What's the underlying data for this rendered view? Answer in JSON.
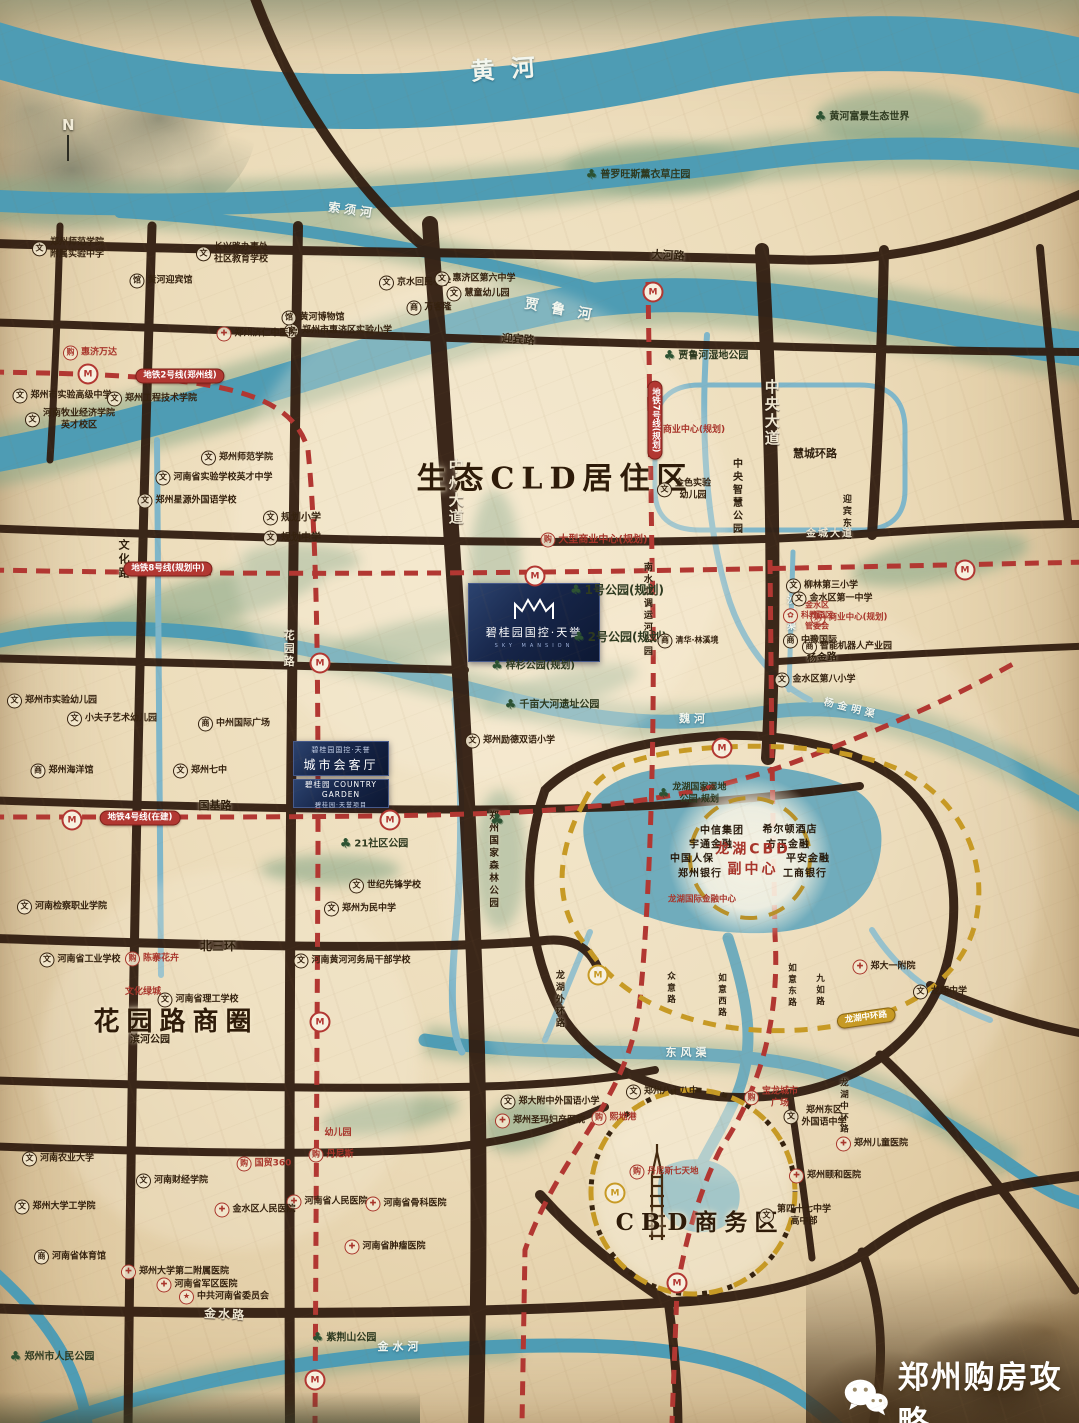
{
  "watermark": {
    "text": "郑州购房攻略"
  },
  "compass": {
    "label": "N"
  },
  "project": {
    "main_card": {
      "name": "碧桂园国控·天誉",
      "subtitle": "SKY MANSION"
    },
    "card2": {
      "line1": "碧桂园国控·天誉",
      "line2": "城市会客厅"
    },
    "card3": {
      "brand": "碧桂园 COUNTRY GARDEN",
      "line2": "碧桂园·天誉项目"
    }
  },
  "colors": {
    "parchment": "#ecdcba",
    "river": "#4e9cb4",
    "road": "#311d10",
    "metro_red": "#b23732",
    "ring_yellow": "#c79a25",
    "label_dark": "#35220f",
    "red_text": "#a8352b",
    "project_navy": "#17264a",
    "green": "#7fa383"
  },
  "map": {
    "labels": [
      {
        "x": 505,
        "y": 70,
        "t": "黄  河",
        "k": "river",
        "fs": 24,
        "r": -4
      },
      {
        "x": 352,
        "y": 211,
        "t": "索须河",
        "k": "river",
        "fs": 12,
        "r": 8
      },
      {
        "x": 560,
        "y": 310,
        "t": "贾 鲁 河",
        "k": "river",
        "fs": 14,
        "r": 10
      },
      {
        "x": 688,
        "y": 1053,
        "t": "东风渠",
        "k": "river",
        "fs": 11
      },
      {
        "x": 400,
        "y": 1347,
        "t": "金水河",
        "k": "river",
        "fs": 11
      },
      {
        "x": 851,
        "y": 709,
        "t": "杨金明渠",
        "k": "river",
        "fs": 10,
        "r": 14
      },
      {
        "x": 694,
        "y": 719,
        "t": "魏河",
        "k": "river",
        "fs": 11
      },
      {
        "x": 789,
        "y": 608,
        "t": "白沙明渠",
        "k": "river",
        "fs": 9,
        "v": 1
      },
      {
        "x": 668,
        "y": 256,
        "t": "大河路",
        "k": "rd",
        "fs": 11,
        "r": 3
      },
      {
        "x": 518,
        "y": 340,
        "t": "迎宾路",
        "k": "rd",
        "fs": 11,
        "r": 4
      },
      {
        "x": 215,
        "y": 806,
        "t": "国基路",
        "k": "rd",
        "fs": 11
      },
      {
        "x": 218,
        "y": 947,
        "t": "北三环",
        "k": "rd",
        "fs": 12
      },
      {
        "x": 822,
        "y": 658,
        "t": "杨金路",
        "k": "rd",
        "fs": 10,
        "r": -4
      },
      {
        "x": 815,
        "y": 454,
        "t": "慧城环路",
        "k": "rd",
        "fs": 11
      },
      {
        "x": 845,
        "y": 518,
        "t": "迎宾东路",
        "k": "rd",
        "fs": 9,
        "v": 1
      },
      {
        "x": 123,
        "y": 560,
        "t": "文化路",
        "k": "rd",
        "fs": 11,
        "v": 1
      },
      {
        "x": 558,
        "y": 1000,
        "t": "龙湖外环路",
        "k": "rd",
        "fs": 9,
        "v": 1
      },
      {
        "x": 670,
        "y": 989,
        "t": "众意路",
        "k": "rd",
        "fs": 8.5,
        "v": 1
      },
      {
        "x": 721,
        "y": 996,
        "t": "如意西路",
        "k": "rd",
        "fs": 8.5,
        "v": 1
      },
      {
        "x": 791,
        "y": 986,
        "t": "如意东路",
        "k": "rd",
        "fs": 8.5,
        "v": 1
      },
      {
        "x": 819,
        "y": 991,
        "t": "九如路",
        "k": "rd",
        "fs": 8.5,
        "v": 1
      },
      {
        "x": 843,
        "y": 1107,
        "t": "龙湖中环路",
        "k": "rd",
        "fs": 8.5,
        "v": 1
      },
      {
        "x": 455,
        "y": 492,
        "t": "中州大道",
        "k": "rw",
        "fs": 15,
        "v": 1
      },
      {
        "x": 771,
        "y": 413,
        "t": "中央大道",
        "k": "rw",
        "fs": 15,
        "v": 1
      },
      {
        "x": 288,
        "y": 649,
        "t": "花园路",
        "k": "rw",
        "fs": 11,
        "v": 1
      },
      {
        "x": 225,
        "y": 1315,
        "t": "金水路",
        "k": "rw",
        "fs": 12,
        "r": 3
      },
      {
        "x": 830,
        "y": 534,
        "t": "金城大道",
        "k": "rw",
        "fs": 10
      },
      {
        "x": 736,
        "y": 497,
        "t": "中央智慧公园",
        "k": "rd",
        "fs": 10,
        "v": 1
      },
      {
        "x": 646,
        "y": 610,
        "t": "南水北调运河公园",
        "k": "rd",
        "fs": 9,
        "v": 1
      },
      {
        "x": 492,
        "y": 860,
        "t": "郑州国家森林公园",
        "k": "rd",
        "fs": 9.5,
        "v": 1
      },
      {
        "x": 555,
        "y": 479,
        "t": "生态CLD居住区",
        "k": "zone",
        "fs": 30
      },
      {
        "x": 176,
        "y": 1023,
        "t": "花园路商圈",
        "k": "zone",
        "fs": 26
      },
      {
        "x": 700,
        "y": 1223,
        "t": "CBD商务区",
        "k": "zone",
        "fs": 23
      },
      {
        "x": 862,
        "y": 117,
        "t": "黄河富景生态世界",
        "k": "park",
        "fs": 10
      },
      {
        "x": 638,
        "y": 175,
        "t": "普罗旺斯薰衣草庄园",
        "k": "park",
        "fs": 10
      },
      {
        "x": 706,
        "y": 356,
        "t": "贾鲁河湿地公园",
        "k": "park",
        "fs": 10
      },
      {
        "x": 617,
        "y": 591,
        "t": "1号公园(规划)",
        "k": "park",
        "fs": 12
      },
      {
        "x": 620,
        "y": 638,
        "t": "2号公园(规划)",
        "k": "park",
        "fs": 12
      },
      {
        "x": 533,
        "y": 666,
        "t": "梓杉公园(规划)",
        "k": "park",
        "fs": 10
      },
      {
        "x": 552,
        "y": 705,
        "t": "千亩大河遗址公园",
        "k": "park",
        "fs": 10
      },
      {
        "x": 374,
        "y": 844,
        "t": "21社区公园",
        "k": "park",
        "fs": 10
      },
      {
        "x": 150,
        "y": 1040,
        "t": "滨河公园",
        "k": "rd",
        "fs": 10
      },
      {
        "x": 692,
        "y": 794,
        "t": "龙湖国家湿地\n公园·规划",
        "k": "park",
        "fs": 9
      },
      {
        "x": 344,
        "y": 1338,
        "t": "紫荆山公园",
        "k": "park",
        "fs": 10
      },
      {
        "x": 52,
        "y": 1357,
        "t": "郑州市人民公园",
        "k": "park",
        "fs": 10
      },
      {
        "x": 497,
        "y": 820,
        "t": "",
        "k": "tree"
      },
      {
        "x": 68,
        "y": 249,
        "t": "郑州师范学院\n附属实验中学",
        "k": "school",
        "fs": 9
      },
      {
        "x": 232,
        "y": 254,
        "t": "长兴路办事处\n社区教育学校",
        "k": "school",
        "fs": 9
      },
      {
        "x": 415,
        "y": 283,
        "t": "京水回民小学",
        "k": "school",
        "fs": 9
      },
      {
        "x": 475,
        "y": 279,
        "t": "惠济区第六中学",
        "k": "school",
        "fs": 9
      },
      {
        "x": 478,
        "y": 294,
        "t": "慧童幼儿园",
        "k": "school",
        "fs": 9
      },
      {
        "x": 338,
        "y": 331,
        "t": "郑州市惠济区实验小学",
        "k": "school",
        "fs": 9
      },
      {
        "x": 62,
        "y": 396,
        "t": "郑州市实验高级中学",
        "k": "school",
        "fs": 9
      },
      {
        "x": 152,
        "y": 399,
        "t": "郑州工程技术学院",
        "k": "school",
        "fs": 9
      },
      {
        "x": 70,
        "y": 420,
        "t": "河南牧业经济学院\n英才校区",
        "k": "school",
        "fs": 9
      },
      {
        "x": 237,
        "y": 458,
        "t": "郑州师范学院",
        "k": "school",
        "fs": 9
      },
      {
        "x": 214,
        "y": 478,
        "t": "河南省实验学校英才中学",
        "k": "school",
        "fs": 9
      },
      {
        "x": 187,
        "y": 501,
        "t": "郑州星源外国语学校",
        "k": "school",
        "fs": 9
      },
      {
        "x": 292,
        "y": 518,
        "t": "规划小学",
        "k": "school",
        "fs": 10
      },
      {
        "x": 292,
        "y": 538,
        "t": "规划中学",
        "k": "school",
        "fs": 10
      },
      {
        "x": 684,
        "y": 490,
        "t": "金色实验\n幼儿园",
        "k": "school",
        "fs": 9
      },
      {
        "x": 510,
        "y": 741,
        "t": "郑州励德双语小学",
        "k": "school",
        "fs": 9
      },
      {
        "x": 200,
        "y": 771,
        "t": "郑州七中",
        "k": "school",
        "fs": 9
      },
      {
        "x": 52,
        "y": 701,
        "t": "郑州市实验幼儿园",
        "k": "school",
        "fs": 9
      },
      {
        "x": 112,
        "y": 719,
        "t": "小夫子艺术幼儿园",
        "k": "school",
        "fs": 9
      },
      {
        "x": 385,
        "y": 886,
        "t": "世纪先锋学校",
        "k": "school",
        "fs": 9
      },
      {
        "x": 360,
        "y": 909,
        "t": "郑州为民中学",
        "k": "school",
        "fs": 9
      },
      {
        "x": 80,
        "y": 960,
        "t": "河南省工业学校",
        "k": "school",
        "fs": 9
      },
      {
        "x": 352,
        "y": 961,
        "t": "河南黄河河务局干部学校",
        "k": "school",
        "fs": 9
      },
      {
        "x": 62,
        "y": 907,
        "t": "河南检察职业学院",
        "k": "school",
        "fs": 9
      },
      {
        "x": 198,
        "y": 1000,
        "t": "河南省理工学校",
        "k": "school",
        "fs": 9
      },
      {
        "x": 58,
        "y": 1159,
        "t": "河南农业大学",
        "k": "school",
        "fs": 9
      },
      {
        "x": 172,
        "y": 1181,
        "t": "河南财经学院",
        "k": "school",
        "fs": 9
      },
      {
        "x": 55,
        "y": 1207,
        "t": "郑州大学工学院",
        "k": "school",
        "fs": 9
      },
      {
        "x": 550,
        "y": 1102,
        "t": "郑大附中外国语小学",
        "k": "school",
        "fs": 9
      },
      {
        "x": 662,
        "y": 1092,
        "t": "郑州八十八中",
        "k": "school",
        "fs": 9
      },
      {
        "x": 815,
        "y": 1117,
        "t": "郑州东区\n外国语中学",
        "k": "school",
        "fs": 9
      },
      {
        "x": 940,
        "y": 992,
        "t": "龙翔中学",
        "k": "school",
        "fs": 9
      },
      {
        "x": 795,
        "y": 1216,
        "t": "第四十七中学\n高中部",
        "k": "school",
        "fs": 9
      },
      {
        "x": 822,
        "y": 586,
        "t": "柳林第三小学",
        "k": "school",
        "fs": 9
      },
      {
        "x": 832,
        "y": 599,
        "t": "金水区第一中学",
        "k": "school",
        "fs": 9
      },
      {
        "x": 815,
        "y": 680,
        "t": "金水区第八小学",
        "k": "school",
        "fs": 9
      },
      {
        "x": 234,
        "y": 724,
        "t": "中州国际广场",
        "k": "biz",
        "fs": 9
      },
      {
        "x": 429,
        "y": 308,
        "t": "万客隆",
        "k": "biz",
        "fs": 9
      },
      {
        "x": 847,
        "y": 647,
        "t": "智能机器人产业园",
        "k": "biz",
        "fs": 9
      },
      {
        "x": 810,
        "y": 641,
        "t": "中豫国际",
        "k": "biz",
        "fs": 9
      },
      {
        "x": 70,
        "y": 1257,
        "t": "河南省体育馆",
        "k": "biz",
        "fs": 9
      },
      {
        "x": 62,
        "y": 771,
        "t": "郑州海洋馆",
        "k": "biz",
        "fs": 9
      },
      {
        "x": 688,
        "y": 641,
        "t": "清华·林溪境",
        "k": "biz",
        "fs": 8
      },
      {
        "x": 313,
        "y": 318,
        "t": "黄河博物馆",
        "k": "mus",
        "fs": 9
      },
      {
        "x": 161,
        "y": 281,
        "t": "黄河迎宾馆",
        "k": "mus",
        "fs": 9
      },
      {
        "x": 257,
        "y": 334,
        "t": "郑州济仁中医院",
        "k": "hosp",
        "fs": 9
      },
      {
        "x": 884,
        "y": 967,
        "t": "郑大一附院",
        "k": "hosp",
        "fs": 9
      },
      {
        "x": 872,
        "y": 1144,
        "t": "郑州儿童医院",
        "k": "hosp",
        "fs": 9
      },
      {
        "x": 825,
        "y": 1176,
        "t": "郑州颐和医院",
        "k": "hosp",
        "fs": 9
      },
      {
        "x": 540,
        "y": 1121,
        "t": "郑州圣玛妇产医院",
        "k": "hosp",
        "fs": 9
      },
      {
        "x": 327,
        "y": 1202,
        "t": "河南省人民医院",
        "k": "hosp",
        "fs": 9
      },
      {
        "x": 406,
        "y": 1204,
        "t": "河南省骨科医院",
        "k": "hosp",
        "fs": 9
      },
      {
        "x": 385,
        "y": 1247,
        "t": "河南省肿瘤医院",
        "k": "hosp",
        "fs": 9
      },
      {
        "x": 255,
        "y": 1210,
        "t": "金水区人民医院",
        "k": "hosp",
        "fs": 9
      },
      {
        "x": 175,
        "y": 1272,
        "t": "郑州大学第二附属医院",
        "k": "hosp",
        "fs": 9
      },
      {
        "x": 197,
        "y": 1285,
        "t": "河南省军区医院",
        "k": "hosp",
        "fs": 9
      },
      {
        "x": 224,
        "y": 1297,
        "t": "中共河南省委员会",
        "k": "gov",
        "fs": 9
      },
      {
        "x": 90,
        "y": 353,
        "t": "惠济万达",
        "k": "rshop",
        "fs": 9
      },
      {
        "x": 694,
        "y": 431,
        "t": "商业中心(规划)",
        "k": "rtxt",
        "fs": 9
      },
      {
        "x": 594,
        "y": 540,
        "t": "大型商业中心(规划)",
        "k": "rshop",
        "fs": 10
      },
      {
        "x": 849,
        "y": 618,
        "t": "商业中心(规划)",
        "k": "rshop",
        "fs": 8.5
      },
      {
        "x": 808,
        "y": 616,
        "t": "金水区\n科教园区\n管委会",
        "k": "rgov",
        "fs": 8
      },
      {
        "x": 152,
        "y": 959,
        "t": "陈寨花卉",
        "k": "rshop",
        "fs": 9
      },
      {
        "x": 143,
        "y": 993,
        "t": "文化绿城",
        "k": "rtxt",
        "fs": 9
      },
      {
        "x": 338,
        "y": 1134,
        "t": "幼儿园",
        "k": "rtxt",
        "fs": 9
      },
      {
        "x": 614,
        "y": 1118,
        "t": "熙地港",
        "k": "rshop",
        "fs": 9
      },
      {
        "x": 771,
        "y": 1098,
        "t": "宝龙城市\n广场",
        "k": "rshop",
        "fs": 9
      },
      {
        "x": 664,
        "y": 1172,
        "t": "丹尼斯七天地",
        "k": "rshop",
        "fs": 8.5
      },
      {
        "x": 331,
        "y": 1155,
        "t": "丹尼斯",
        "k": "rshop",
        "fs": 9
      },
      {
        "x": 264,
        "y": 1164,
        "t": "国贸360",
        "k": "rshop",
        "fs": 9
      },
      {
        "x": 702,
        "y": 900,
        "t": "龙湖国际金融中心",
        "k": "rtxt",
        "fs": 8.5
      },
      {
        "x": 722,
        "y": 831,
        "t": "中信集团",
        "k": "cbd",
        "fs": 10
      },
      {
        "x": 790,
        "y": 830,
        "t": "希尔顿酒店",
        "k": "cbd",
        "fs": 10
      },
      {
        "x": 711,
        "y": 845,
        "t": "宇通金融",
        "k": "cbd",
        "fs": 10
      },
      {
        "x": 788,
        "y": 845,
        "t": "方正金融",
        "k": "cbd",
        "fs": 10
      },
      {
        "x": 692,
        "y": 859,
        "t": "中国人保",
        "k": "cbd",
        "fs": 10
      },
      {
        "x": 808,
        "y": 859,
        "t": "平安金融",
        "k": "cbd",
        "fs": 10
      },
      {
        "x": 700,
        "y": 874,
        "t": "郑州银行",
        "k": "cbd",
        "fs": 10
      },
      {
        "x": 805,
        "y": 874,
        "t": "工商银行",
        "k": "cbd",
        "fs": 10
      },
      {
        "x": 753,
        "y": 860,
        "t": "龙湖CBD\n副中心",
        "k": "cbdt",
        "fs": 14
      },
      {
        "x": 180,
        "y": 376,
        "t": "地铁2号线(郑州线)",
        "k": "pill",
        "fs": 8.5
      },
      {
        "x": 168,
        "y": 569,
        "t": "地铁8号线(规划中)",
        "k": "pill",
        "fs": 8.5
      },
      {
        "x": 140,
        "y": 818,
        "t": "地铁4号线(在建)",
        "k": "pill",
        "fs": 8.5
      },
      {
        "x": 655,
        "y": 420,
        "t": "地铁7号线(规划)",
        "k": "pill",
        "fs": 8.5,
        "v": 1
      },
      {
        "x": 866,
        "y": 1018,
        "t": "龙湖中环路",
        "k": "ypill",
        "fs": 8.5,
        "r": -8
      }
    ],
    "metro_stations": [
      {
        "x": 88,
        "y": 374
      },
      {
        "x": 320,
        "y": 663
      },
      {
        "x": 320,
        "y": 1022
      },
      {
        "x": 315,
        "y": 1380
      },
      {
        "x": 535,
        "y": 576
      },
      {
        "x": 965,
        "y": 570
      },
      {
        "x": 653,
        "y": 292
      },
      {
        "x": 722,
        "y": 748
      },
      {
        "x": 390,
        "y": 820
      },
      {
        "x": 72,
        "y": 820
      },
      {
        "x": 677,
        "y": 1283
      },
      {
        "x": 598,
        "y": 975,
        "c": "y"
      },
      {
        "x": 615,
        "y": 1193,
        "c": "y"
      }
    ]
  }
}
